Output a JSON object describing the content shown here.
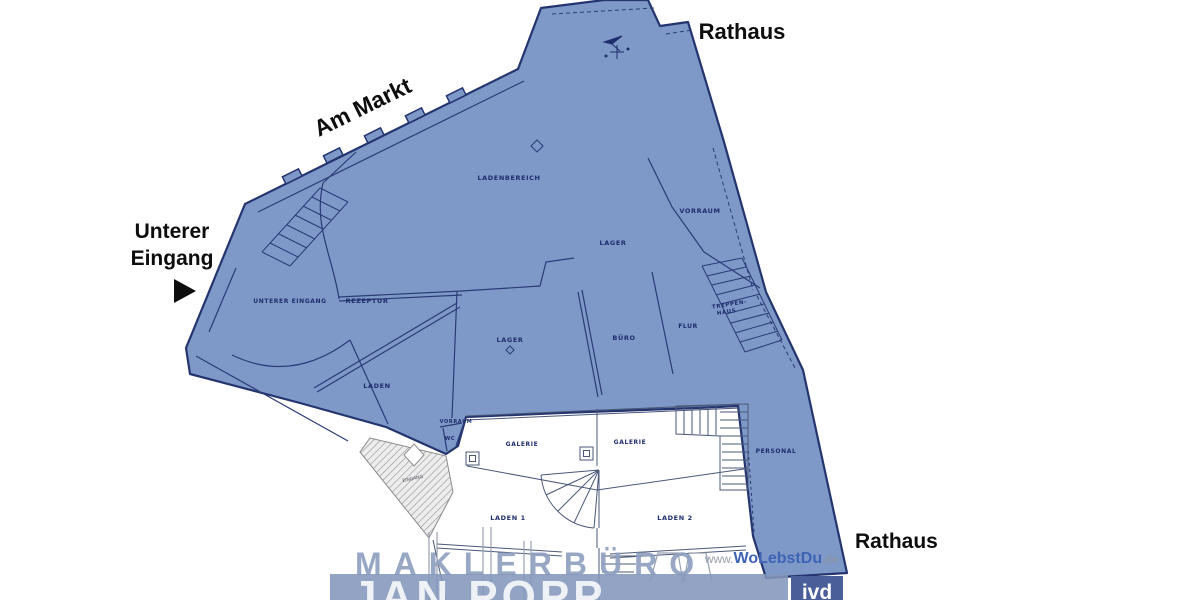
{
  "annotations": {
    "rathaus_top": "Rathaus",
    "am_markt": "Am Markt",
    "unterer_line1": "Unterer",
    "unterer_line2": "Eingang",
    "rathaus_bottom": "Rathaus"
  },
  "rooms": {
    "ladenbereich": "LADENBEREICH",
    "vorraum_top": "VORRAUM",
    "lager_top": "LAGER",
    "unterer_eingang": "UNTERER EINGANG",
    "rezeptur": "REZEPTUR",
    "lager_mid": "LAGER",
    "buero": "BÜRO",
    "flur": "FLUR",
    "treppenhaus_line1": "TREPPEN-",
    "treppenhaus_line2": "HAUS",
    "laden": "LADEN",
    "vorraum_small": "VORRAUM",
    "wc": "WC",
    "galerie_left": "GALERIE",
    "galerie_right": "GALERIE",
    "personal": "PERSONAL",
    "laden_1": "LADEN 1",
    "laden_2": "LADEN 2",
    "eingang_hatch": "EINGANG"
  },
  "watermark": {
    "broker_line1": "MAKLERBÜRO",
    "broker_line2": "JAN POPP",
    "website_prefix": "www.",
    "website_name": "WoLebstDu",
    "website_suffix": ".de",
    "badge": "ivd"
  },
  "colors": {
    "highlight_area_fill": "#7E99C8",
    "wall_line": "#2A3B76",
    "watermark_band": "#8496BB",
    "brand_blue": "#3E63B5",
    "badge_box": "#4A5E99"
  }
}
